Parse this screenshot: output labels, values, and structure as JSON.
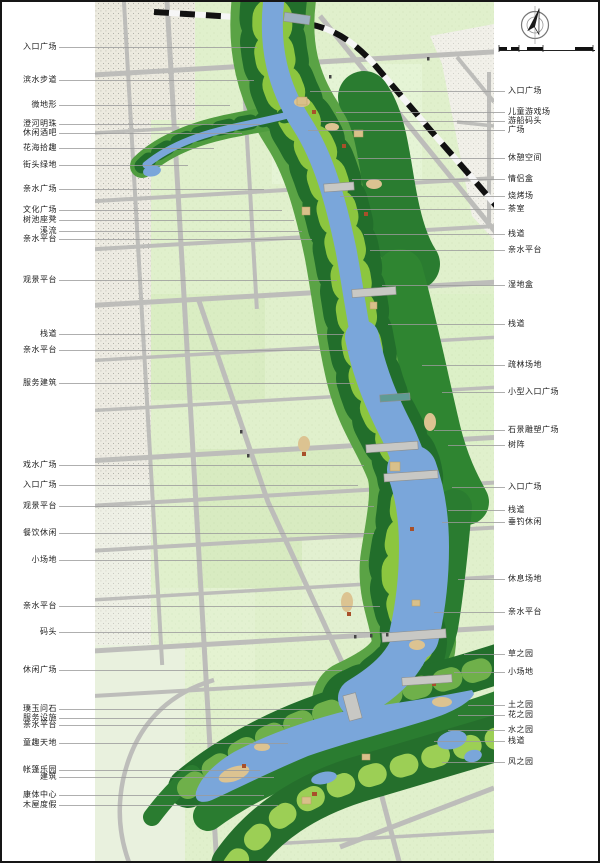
{
  "page": {
    "title": "riverfront landscape masterplan drawing",
    "orientation_icon": "north-arrow-icon",
    "scale_bar": "graphic-scale-bar"
  },
  "colors": {
    "field_green": "#e0f0cc",
    "park_mid_green": "#57a33f",
    "forest_dark_green": "#226e2b",
    "park_light_green": "#8cc63f",
    "river_blue": "#7aa6da",
    "road_gray": "#bdbdba",
    "urban_gray": "#eceadf",
    "sand_tan": "#dcc391",
    "plaza_tan": "#d9c08a",
    "railway_black": "#111111",
    "leader_gray": "#9b9b9b"
  },
  "labels_left": [
    {
      "text": "入口广场",
      "y": 45,
      "lx": 255
    },
    {
      "text": "滨水步道",
      "y": 78,
      "lx": 252
    },
    {
      "text": "微地形",
      "y": 103,
      "lx": 228
    },
    {
      "text": "澄河明珠",
      "y": 122,
      "lx": 258
    },
    {
      "text": "休闲酒吧",
      "y": 131,
      "lx": 240
    },
    {
      "text": "花海拾趣",
      "y": 146,
      "lx": 212
    },
    {
      "text": "街头绿地",
      "y": 163,
      "lx": 186
    },
    {
      "text": "亲水广场",
      "y": 187,
      "lx": 262
    },
    {
      "text": "文化广场",
      "y": 208,
      "lx": 280
    },
    {
      "text": "树池座凳",
      "y": 218,
      "lx": 292
    },
    {
      "text": "溪流",
      "y": 229,
      "lx": 300
    },
    {
      "text": "亲水平台",
      "y": 237,
      "lx": 310
    },
    {
      "text": "观景平台",
      "y": 278,
      "lx": 335
    },
    {
      "text": "栈道",
      "y": 332,
      "lx": 342
    },
    {
      "text": "亲水平台",
      "y": 348,
      "lx": 348
    },
    {
      "text": "服务建筑",
      "y": 381,
      "lx": 352
    },
    {
      "text": "戏水广场",
      "y": 463,
      "lx": 362
    },
    {
      "text": "入口广场",
      "y": 483,
      "lx": 356
    },
    {
      "text": "观景平台",
      "y": 504,
      "lx": 372
    },
    {
      "text": "餐饮休闲",
      "y": 531,
      "lx": 372
    },
    {
      "text": "小场地",
      "y": 558,
      "lx": 366
    },
    {
      "text": "亲水平台",
      "y": 604,
      "lx": 378
    },
    {
      "text": "码头",
      "y": 630,
      "lx": 388
    },
    {
      "text": "休闲广场",
      "y": 668,
      "lx": 340
    },
    {
      "text": "璞玉问石",
      "y": 707,
      "lx": 312
    },
    {
      "text": "服务设施",
      "y": 716,
      "lx": 300
    },
    {
      "text": "亲水平台",
      "y": 723,
      "lx": 288
    },
    {
      "text": "童趣天地",
      "y": 741,
      "lx": 286
    },
    {
      "text": "帐篷乐园",
      "y": 768,
      "lx": 258
    },
    {
      "text": "建筑",
      "y": 775,
      "lx": 272
    },
    {
      "text": "康体中心",
      "y": 793,
      "lx": 262
    },
    {
      "text": "木屋度假",
      "y": 803,
      "lx": 276
    }
  ],
  "labels_right": [
    {
      "text": "入口广场",
      "y": 89,
      "lx": 308
    },
    {
      "text": "儿童游戏场",
      "y": 110,
      "lx": 334
    },
    {
      "text": "游船码头",
      "y": 119,
      "lx": 318
    },
    {
      "text": "广场",
      "y": 128,
      "lx": 306
    },
    {
      "text": "休憩空间",
      "y": 156,
      "lx": 356
    },
    {
      "text": "情侣盒",
      "y": 177,
      "lx": 350
    },
    {
      "text": "烧烤场",
      "y": 194,
      "lx": 338
    },
    {
      "text": "茶室",
      "y": 207,
      "lx": 352
    },
    {
      "text": "栈道",
      "y": 232,
      "lx": 362
    },
    {
      "text": "亲水平台",
      "y": 248,
      "lx": 368
    },
    {
      "text": "湿地盒",
      "y": 283,
      "lx": 380
    },
    {
      "text": "栈道",
      "y": 322,
      "lx": 386
    },
    {
      "text": "疏林场地",
      "y": 363,
      "lx": 420
    },
    {
      "text": "小型入口广场",
      "y": 390,
      "lx": 440
    },
    {
      "text": "石景雕塑广场",
      "y": 428,
      "lx": 432
    },
    {
      "text": "树阵",
      "y": 443,
      "lx": 446
    },
    {
      "text": "入口广场",
      "y": 485,
      "lx": 450
    },
    {
      "text": "栈道",
      "y": 508,
      "lx": 446
    },
    {
      "text": "垂钓休闲",
      "y": 520,
      "lx": 440
    },
    {
      "text": "休息场地",
      "y": 577,
      "lx": 456
    },
    {
      "text": "亲水平台",
      "y": 610,
      "lx": 432
    },
    {
      "text": "草之园",
      "y": 652,
      "lx": 462
    },
    {
      "text": "小场地",
      "y": 670,
      "lx": 452
    },
    {
      "text": "土之园",
      "y": 703,
      "lx": 466
    },
    {
      "text": "花之园",
      "y": 713,
      "lx": 456
    },
    {
      "text": "水之园",
      "y": 728,
      "lx": 446
    },
    {
      "text": "栈道",
      "y": 739,
      "lx": 432
    },
    {
      "text": "风之园",
      "y": 760,
      "lx": 440
    }
  ]
}
